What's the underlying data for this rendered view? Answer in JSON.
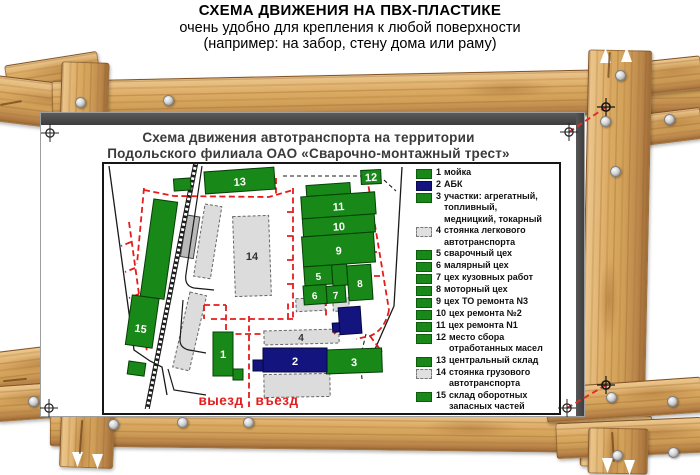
{
  "header": {
    "line1": "СХЕМА ДВИЖЕНИЯ НА ПВХ-ПЛАСТИКЕ",
    "line2": "очень удобно для крепления к любой поверхности",
    "line3": "(например: на забор, стену дома или раму)"
  },
  "sign": {
    "title_line1": "Схема движения автотранспорта на территории",
    "title_line2": "Подольского филиала ОАО «Сварочно-монтажный трест»"
  },
  "map": {
    "exit_label": "выезд",
    "entrance_label": "въезд",
    "labels": {
      "b1": "1",
      "b2": "2",
      "b3": "3",
      "b5": "5",
      "b6": "6",
      "b7": "7",
      "b8": "8",
      "b9": "9",
      "b10": "10",
      "b11": "11",
      "b12": "12",
      "b13": "13",
      "b15": "15",
      "g4": "4",
      "g14": "14"
    }
  },
  "legend": {
    "items": [
      {
        "num": "1",
        "label": "мойка",
        "swatch": "green"
      },
      {
        "num": "2",
        "label": "АБК",
        "swatch": "blue"
      },
      {
        "num": "3",
        "label": "участки: агрегатный,\nтопливный,\nмедницкий, токарный",
        "swatch": "green"
      },
      {
        "num": "4",
        "label": "стоянка легкового\nавтотранспорта",
        "swatch": "gray"
      },
      {
        "num": "5",
        "label": "сварочный цех",
        "swatch": "green"
      },
      {
        "num": "6",
        "label": "малярный цех",
        "swatch": "green"
      },
      {
        "num": "7",
        "label": "цех кузовных работ",
        "swatch": "green"
      },
      {
        "num": "8",
        "label": "моторный цех",
        "swatch": "green"
      },
      {
        "num": "9",
        "label": "цех ТО ремонта N3",
        "swatch": "green"
      },
      {
        "num": "10",
        "label": "цех ремонта №2",
        "swatch": "green"
      },
      {
        "num": "11",
        "label": "цех ремонта N1",
        "swatch": "green"
      },
      {
        "num": "12",
        "label": "место сбора\nотработанных масел",
        "swatch": "green"
      },
      {
        "num": "13",
        "label": "центральный склад",
        "swatch": "green"
      },
      {
        "num": "14",
        "label": "стоянка грузового\nавтотранспорта",
        "swatch": "gray"
      },
      {
        "num": "15",
        "label": "склад оборотных\nзапасных частей",
        "swatch": "green"
      }
    ]
  },
  "colors": {
    "building_green": "#188818",
    "building_blue": "#14147e",
    "route_red": "#e51c1c",
    "parking_gray": "#dcdcdc",
    "sign_edge_dark": "#454545",
    "wood_light": "#ecc78e",
    "wood_dark": "#a06c36"
  }
}
